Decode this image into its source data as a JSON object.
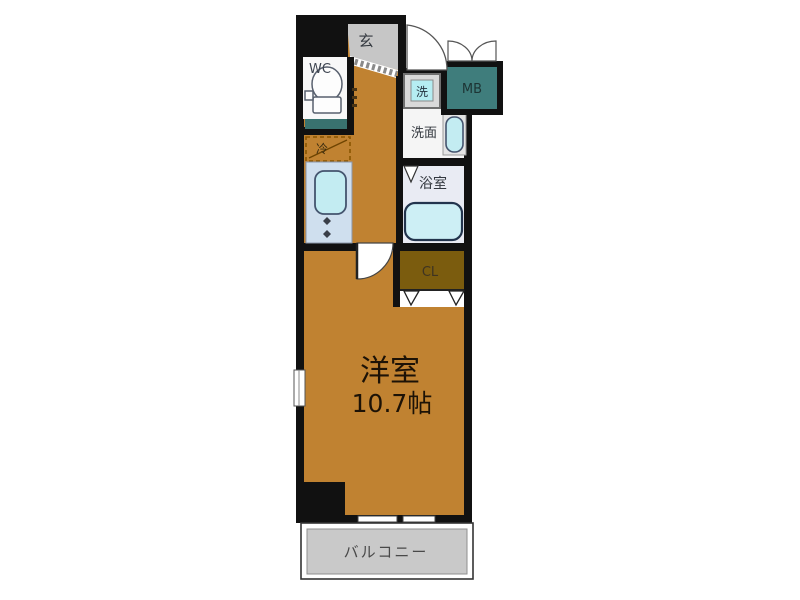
{
  "plan": {
    "type": "apartment-floor-plan",
    "labels": {
      "entrance": "玄",
      "toilet": "WC",
      "washer": "洗",
      "meter_box": "MB",
      "washroom": "洗面",
      "refrigerator": "冷",
      "bathroom": "浴室",
      "closet": "CL",
      "main_room_name": "洋室",
      "main_room_size": "10.7帖",
      "balcony": "バルコニー"
    },
    "colors": {
      "wall": "#111111",
      "floor": "#c08231",
      "entrance_fill": "#c6c6c6",
      "wc_floor": "#f8f8f8",
      "shelf_fill": "#39726f",
      "kitchen_fill": "#cfdfee",
      "fixture_fill": "#c3ecf2",
      "washer_fill": "#b5edf2",
      "washer_case": "#d9d9d9",
      "washroom_floor": "#f5f5f5",
      "bathroom_floor": "#e9ebf3",
      "tub_fill": "#cdeff5",
      "meter_box_fill": "#3f7d7c",
      "closet_fill": "#7b5c0e",
      "balcony_fill": "#c9c9c9"
    }
  }
}
